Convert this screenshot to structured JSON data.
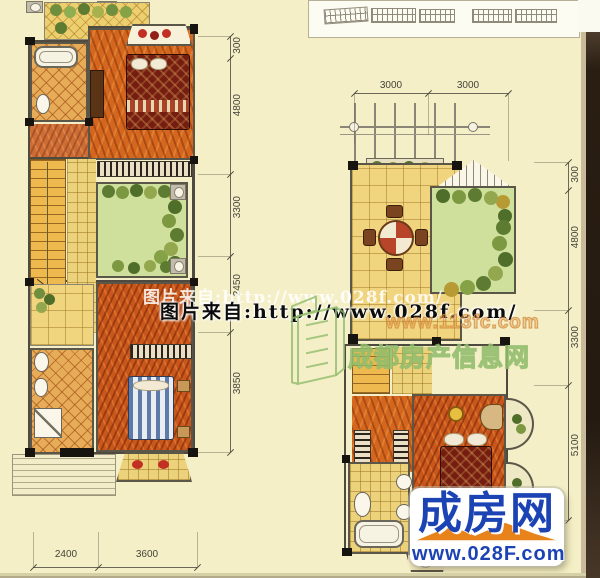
{
  "watermarks": {
    "photo_faint": "图片来自:http://www.028f.com/",
    "photo_bold": "图片来自:http://www.028f.com/",
    "site_url": "www.113fc.com",
    "site_name": "成都房产信息网"
  },
  "logo": {
    "title": "成房网",
    "url": "www.028F.com",
    "blue": "#1c43b4",
    "orange": "#e8831c"
  },
  "left_plan": {
    "dims_right": [
      "300",
      "4800",
      "3300",
      "2450",
      "3850"
    ],
    "dims_bottom": [
      "2400",
      "3600"
    ]
  },
  "right_plan": {
    "dims_top": [
      "3000",
      "3000"
    ],
    "dims_right": [
      "300",
      "4800",
      "3300",
      "5100"
    ]
  },
  "colors": {
    "paper": "#f4efc6",
    "watermark_green": "#91bc6c",
    "watermark_orange": "#d68c3c"
  }
}
